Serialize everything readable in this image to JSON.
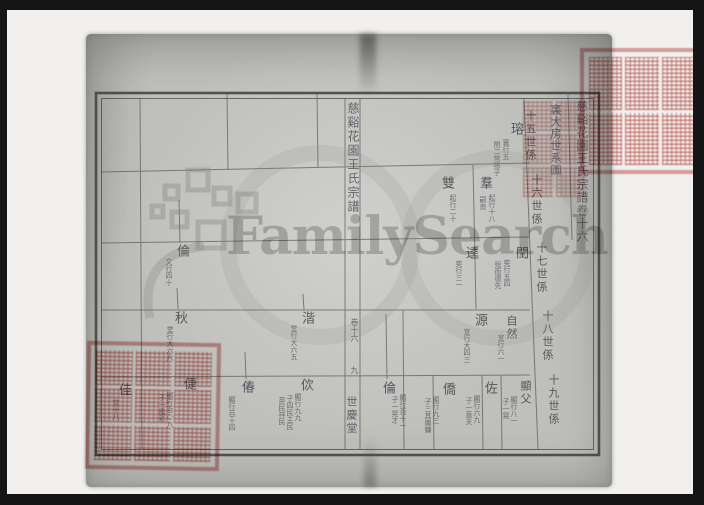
{
  "watermark": {
    "wordmark": "FamilySearch"
  },
  "genealogy": {
    "title_column": "慈谿花園王氏宗譜卷十六",
    "branch_column": "裏大房世系圖",
    "generation_labels": [
      "十五世係",
      "十六世係",
      "十七世係",
      "十八世係",
      "十九世係"
    ],
    "fold": {
      "title": "慈谿花園王氏宗譜",
      "volume": "卷十六",
      "page_number": "九",
      "hall_name": "世慶堂"
    },
    "entries": [
      {
        "name": "瑢",
        "ann": [
          "寰行五",
          "閏二常孫子"
        ]
      },
      {
        "name": "羣",
        "ann": [
          "起行十八",
          "嗣良"
        ]
      },
      {
        "name": "雙",
        "ann": [
          "起行二十"
        ]
      },
      {
        "name": "閏",
        "ann": [
          "奕行五四",
          "殁而德先"
        ]
      },
      {
        "name": "逵",
        "ann": [
          "奕行三一"
        ]
      },
      {
        "name": "自然",
        "ann": [
          "宣行六一"
        ]
      },
      {
        "name": "源",
        "ann": [
          "宣行大四三"
        ]
      },
      {
        "name": "顯父",
        "ann": [
          "顯行八一",
          "子一晃"
        ]
      },
      {
        "name": "佐",
        "ann": [
          "顯行六九",
          "子一直夫"
        ]
      },
      {
        "name": "僑",
        "ann": [
          "顯行九三",
          "子三其繼鏞"
        ]
      },
      {
        "name": "倫",
        "ann": [
          "顯行百十一",
          "子一晃才"
        ]
      },
      {
        "name": "倫",
        "ann": [
          "文行四十"
        ]
      },
      {
        "name": "秋",
        "ann": [
          "堂行大六六"
        ]
      },
      {
        "name": "湝",
        "ann": [
          "堂行大六五"
        ]
      },
      {
        "name": "偆",
        "ann": [
          "顯行百十四"
        ]
      },
      {
        "name": "佽",
        "ann": [
          "顯行九九",
          "子四民主民",
          "英民祥民"
        ]
      },
      {
        "name": "倢",
        "ann": [
          "顯行百○八",
          "子一鳳彩"
        ]
      },
      {
        "name": "佳",
        "ann": [
          "文十八"
        ]
      }
    ]
  },
  "colors": {
    "page_gray": "#bfbfbc",
    "backdrop_white": "#f1f0ee",
    "frame_black": "#151515",
    "ink": "#474750",
    "seal_red": "#c7635e",
    "watermark_gray": "#7a7a77"
  }
}
